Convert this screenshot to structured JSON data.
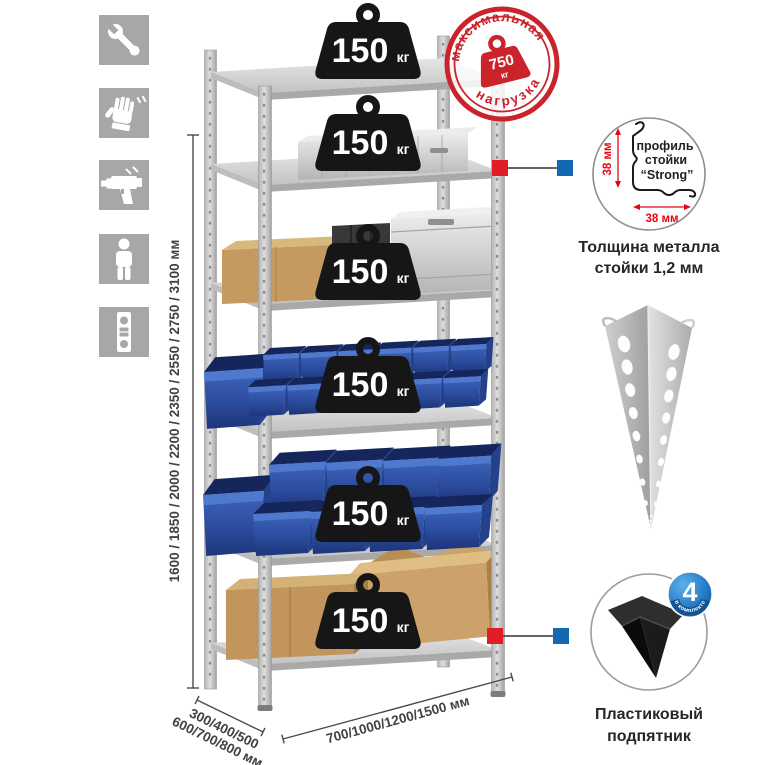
{
  "sidebar": {
    "icons": [
      {
        "label": "wrench"
      },
      {
        "label": "gloves"
      },
      {
        "label": "drill"
      },
      {
        "label": "person"
      },
      {
        "label": "level"
      }
    ]
  },
  "rack": {
    "shelf_count": 6,
    "shelf_load": {
      "value": "150",
      "unit": "кг"
    }
  },
  "max_load_stamp": {
    "arc_top": "максимальная",
    "arc_bottom": "нагрузка",
    "value": "750",
    "unit": "кг"
  },
  "dimensions": {
    "height": "1600 / 1850 / 2000 / 2200 / 2350 / 2550 / 2750 / 3100 мм",
    "depth_line1": "300/400/500",
    "depth_line2": "600/700/800 мм",
    "width": "700/1000/1200/1500 мм"
  },
  "profile_detail": {
    "line1": "профиль",
    "line2": "стойки",
    "line3": "“Strong”",
    "dim_vertical": "38 мм",
    "dim_horizontal": "38 мм",
    "caption_line1": "Толщина металла",
    "caption_line2": "стойки 1,2 мм"
  },
  "foot_detail": {
    "badge_value": "4",
    "badge_arc": "в комплекте",
    "caption_line1": "Пластиковый",
    "caption_line2": "подпятник"
  },
  "colors": {
    "accent_red": "#d0232b",
    "accent_blue": "#1468b0",
    "bin_blue": "#2c4da0",
    "metal_gray": "#c6c6c6",
    "icon_gray": "#a7a7a7"
  }
}
